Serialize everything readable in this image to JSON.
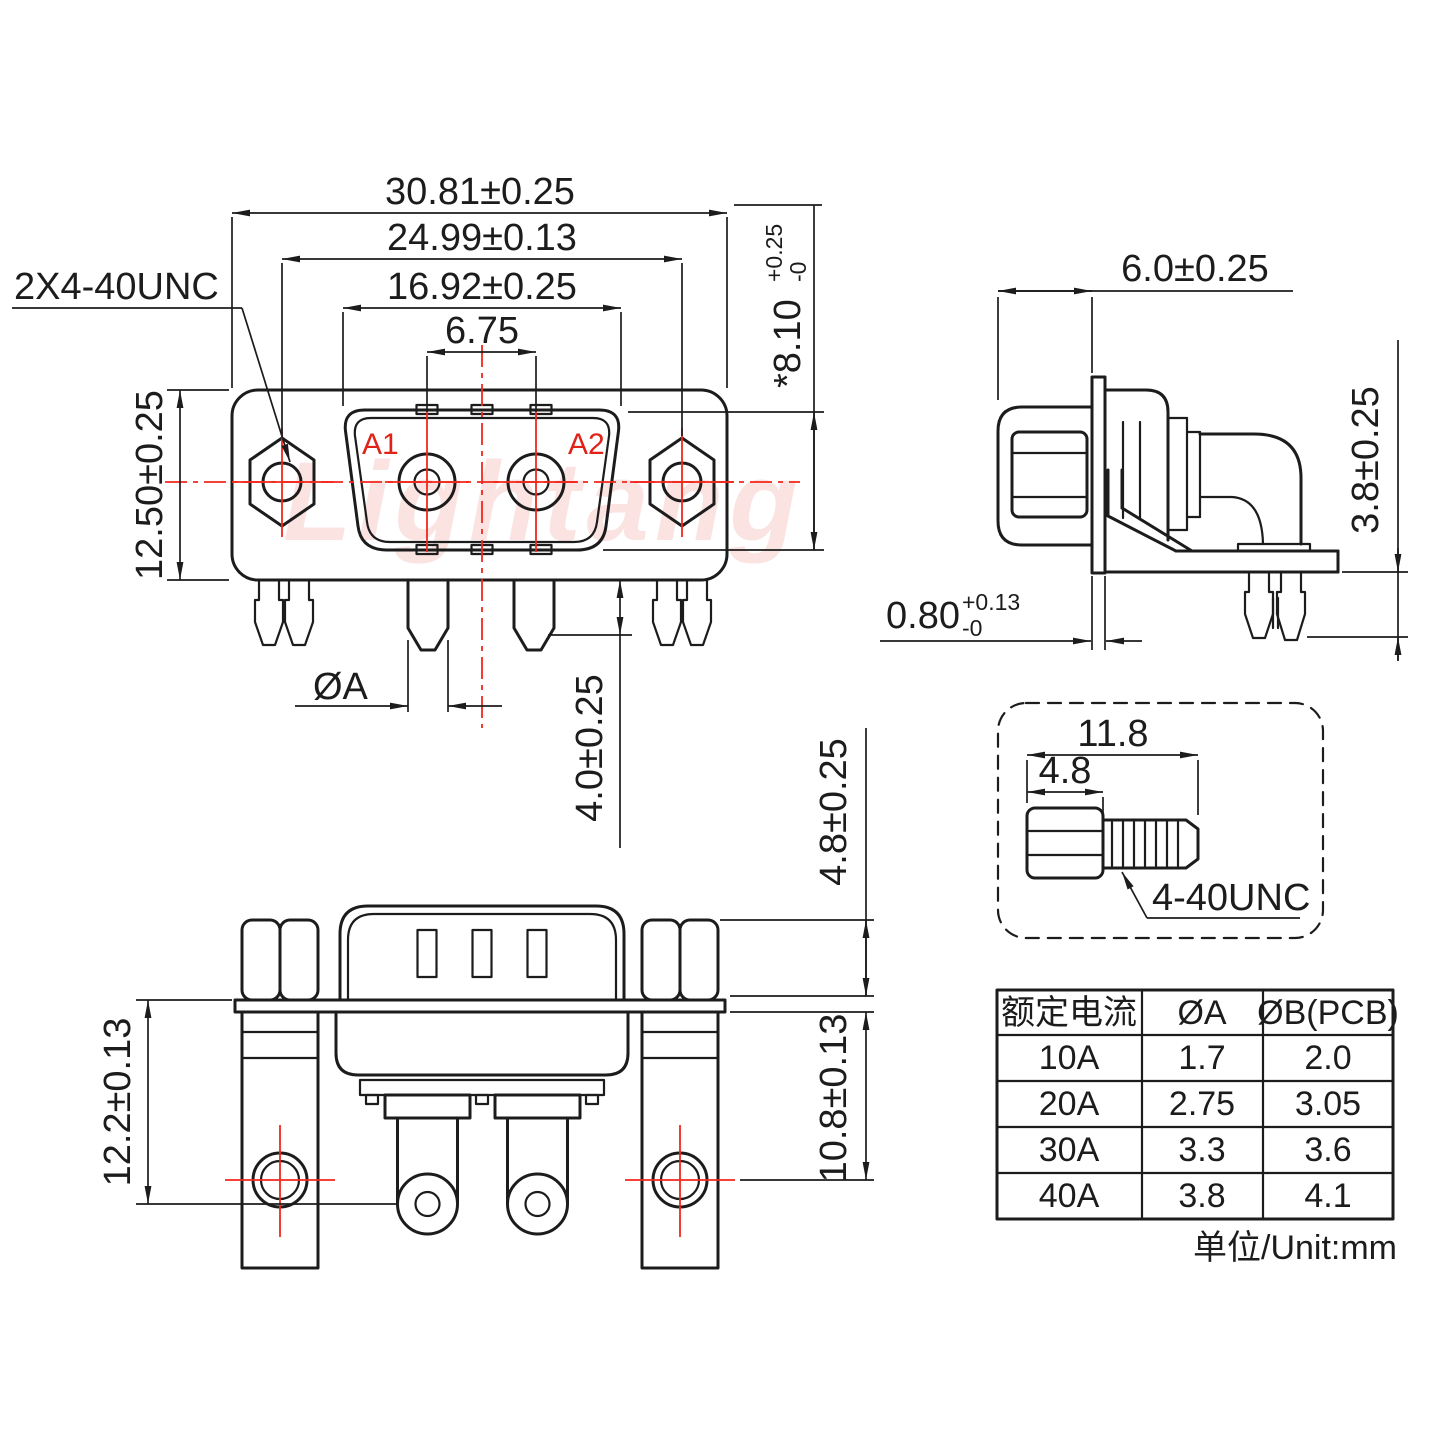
{
  "colors": {
    "line": "#1c1c1c",
    "red_centerline": "#f2271c",
    "red_label": "#e02218",
    "watermark": "#e2574d"
  },
  "watermark_text": "Lightang",
  "front_view": {
    "dim_overall_width": "30.81±0.25",
    "dim_mount_spacing": "24.99±0.13",
    "dim_shell_width": "16.92±0.25",
    "dim_pin_pitch": "6.75",
    "callout_mount_thread": "2X4-40UNC",
    "dim_body_height": "12.50±0.25",
    "dim_shell_height_main": "*8.10",
    "dim_shell_height_plus": "+0.25",
    "dim_shell_height_minus": "-0",
    "pin1_label": "A1",
    "pin2_label": "A2",
    "dim_pin_diameter": "ØA",
    "dim_pin_tip_length": "4.0±0.25"
  },
  "side_view": {
    "dim_front_depth": "6.0±0.25",
    "dim_bracket_height": "3.8±0.25",
    "dim_flange_thickness_main": "0.80",
    "dim_flange_thickness_plus": "+0.13",
    "dim_flange_thickness_minus": "-0"
  },
  "plan_view": {
    "dim_nut_height": "4.8±0.25",
    "dim_flange_to_pin_hole": "12.2±0.13",
    "dim_flange_to_mount_hole": "10.8±0.13"
  },
  "screw_detail": {
    "dim_overall_length": "11.8",
    "dim_head_length": "4.8",
    "thread_callout": "4-40UNC"
  },
  "spec_table": {
    "headers": [
      "额定电流",
      "ØA",
      "ØB(PCB)"
    ],
    "rows": [
      [
        "10A",
        "1.7",
        "2.0"
      ],
      [
        "20A",
        "2.75",
        "3.05"
      ],
      [
        "30A",
        "3.3",
        "3.6"
      ],
      [
        "40A",
        "3.8",
        "4.1"
      ]
    ],
    "unit_note": "单位/Unit:mm"
  }
}
